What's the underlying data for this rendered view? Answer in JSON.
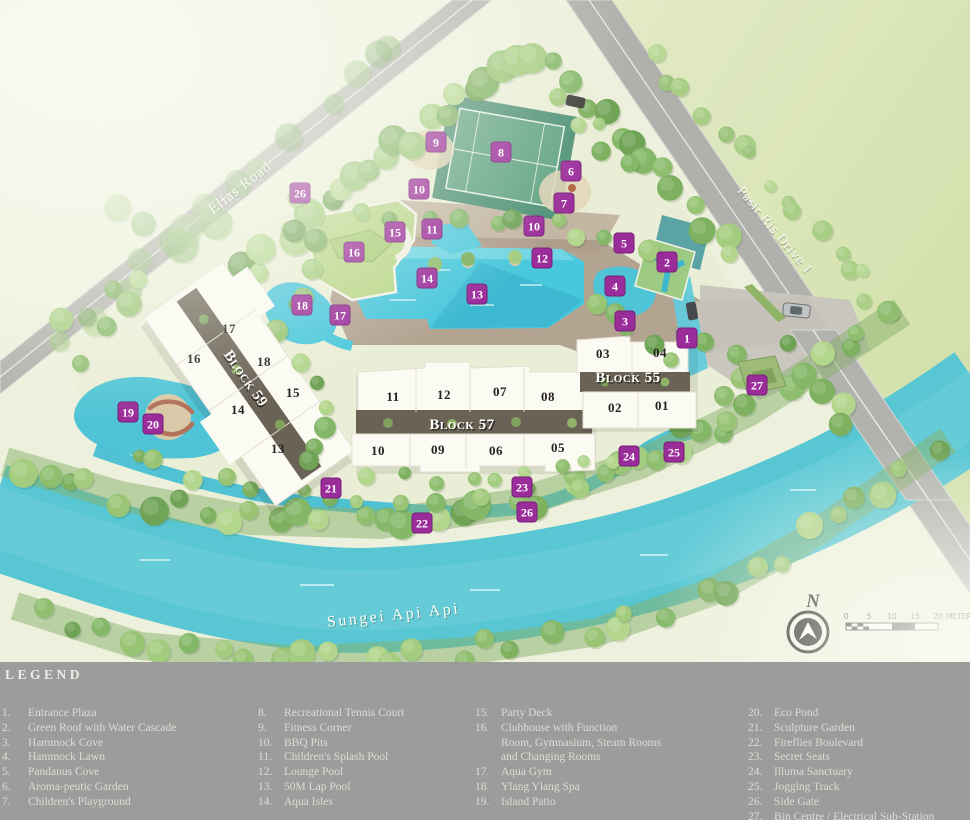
{
  "legend": {
    "title": "LEGEND",
    "columns": [
      {
        "x": 2,
        "items": [
          {
            "num": "1.",
            "label": "Entrance Plaza"
          },
          {
            "num": "2.",
            "label": "Green Roof with Water Cascade"
          },
          {
            "num": "3.",
            "label": "Hammock Cove"
          },
          {
            "num": "4.",
            "label": "Hammock Lawn"
          },
          {
            "num": "5.",
            "label": "Pandanus Cove"
          },
          {
            "num": "6.",
            "label": "Aroma-peutic Garden"
          },
          {
            "num": "7.",
            "label": "Children's Playground"
          }
        ]
      },
      {
        "x": 258,
        "items": [
          {
            "num": "8.",
            "label": "Recreational Tennis Court"
          },
          {
            "num": "9.",
            "label": "Fitness Corner"
          },
          {
            "num": "10.",
            "label": "BBQ Pits"
          },
          {
            "num": "11.",
            "label": "Children's Splash Pool"
          },
          {
            "num": "12.",
            "label": "Lounge Pool"
          },
          {
            "num": "13.",
            "label": "50M Lap Pool"
          },
          {
            "num": "14.",
            "label": "Aqua Isles"
          }
        ]
      },
      {
        "x": 475,
        "items": [
          {
            "num": "15.",
            "label": "Party Deck"
          },
          {
            "num": "16.",
            "label": "Clubhouse with Function\nRoom, Gymnasium, Steam Rooms\nand Changing Rooms"
          },
          {
            "num": "17.",
            "label": "Aqua Gym"
          },
          {
            "num": "18.",
            "label": "Ylang Ylang Spa"
          },
          {
            "num": "19.",
            "label": "Island Patio"
          }
        ]
      },
      {
        "x": 748,
        "items": [
          {
            "num": "20.",
            "label": "Eco Pond"
          },
          {
            "num": "21.",
            "label": "Sculpture Garden"
          },
          {
            "num": "22.",
            "label": "Fireflies Boulevard"
          },
          {
            "num": "23.",
            "label": "Secret Seats"
          },
          {
            "num": "24.",
            "label": "Illuma Sanctuary"
          },
          {
            "num": "25.",
            "label": "Jogging Track"
          },
          {
            "num": "26.",
            "label": "Side Gate"
          },
          {
            "num": "27.",
            "label": "Bin Centre / Electrical Sub-Station"
          }
        ]
      }
    ]
  },
  "map": {
    "place_labels": [
      {
        "text": "Elias Road",
        "x": 243,
        "y": 191,
        "rot": -38,
        "size": 15,
        "ls": 1
      },
      {
        "text": "Pasir Ris Drive 1",
        "x": 772,
        "y": 233,
        "rot": 50,
        "size": 13.5,
        "ls": 1
      },
      {
        "text": "Sungei Api Api",
        "x": 394,
        "y": 620,
        "rot": -6,
        "size": 16,
        "ls": 2.5
      }
    ],
    "block_labels": [
      {
        "text": "Block 59",
        "x": 242,
        "y": 381,
        "rot": 55
      },
      {
        "text": "Block 57",
        "x": 462,
        "y": 429,
        "rot": 0
      },
      {
        "text": "Block 55",
        "x": 628,
        "y": 382,
        "rot": 0
      }
    ],
    "unit_labels": [
      {
        "text": "17",
        "x": 229,
        "y": 333
      },
      {
        "text": "16",
        "x": 194,
        "y": 363
      },
      {
        "text": "18",
        "x": 264,
        "y": 366
      },
      {
        "text": "15",
        "x": 293,
        "y": 397
      },
      {
        "text": "14",
        "x": 238,
        "y": 414
      },
      {
        "text": "13",
        "x": 278,
        "y": 453
      },
      {
        "text": "11",
        "x": 393,
        "y": 401
      },
      {
        "text": "12",
        "x": 444,
        "y": 399
      },
      {
        "text": "07",
        "x": 500,
        "y": 396
      },
      {
        "text": "08",
        "x": 548,
        "y": 401
      },
      {
        "text": "10",
        "x": 378,
        "y": 455
      },
      {
        "text": "09",
        "x": 438,
        "y": 454
      },
      {
        "text": "06",
        "x": 496,
        "y": 455
      },
      {
        "text": "05",
        "x": 558,
        "y": 452
      },
      {
        "text": "03",
        "x": 603,
        "y": 358
      },
      {
        "text": "04",
        "x": 660,
        "y": 357
      },
      {
        "text": "02",
        "x": 615,
        "y": 412
      },
      {
        "text": "01",
        "x": 662,
        "y": 410
      }
    ],
    "markers": [
      {
        "n": "1",
        "x": 687,
        "y": 338
      },
      {
        "n": "2",
        "x": 667,
        "y": 262
      },
      {
        "n": "3",
        "x": 625,
        "y": 321
      },
      {
        "n": "4",
        "x": 615,
        "y": 286
      },
      {
        "n": "5",
        "x": 624,
        "y": 243
      },
      {
        "n": "6",
        "x": 571,
        "y": 171
      },
      {
        "n": "7",
        "x": 564,
        "y": 203
      },
      {
        "n": "8",
        "x": 501,
        "y": 152
      },
      {
        "n": "9",
        "x": 436,
        "y": 142
      },
      {
        "n": "10",
        "x": 419,
        "y": 189
      },
      {
        "n": "10",
        "x": 534,
        "y": 226
      },
      {
        "n": "11",
        "x": 432,
        "y": 229
      },
      {
        "n": "12",
        "x": 542,
        "y": 258
      },
      {
        "n": "13",
        "x": 477,
        "y": 294
      },
      {
        "n": "14",
        "x": 427,
        "y": 278
      },
      {
        "n": "15",
        "x": 395,
        "y": 232
      },
      {
        "n": "16",
        "x": 354,
        "y": 252
      },
      {
        "n": "17",
        "x": 340,
        "y": 315
      },
      {
        "n": "18",
        "x": 302,
        "y": 305
      },
      {
        "n": "19",
        "x": 128,
        "y": 412
      },
      {
        "n": "20",
        "x": 153,
        "y": 424
      },
      {
        "n": "21",
        "x": 331,
        "y": 488
      },
      {
        "n": "22",
        "x": 422,
        "y": 523
      },
      {
        "n": "23",
        "x": 522,
        "y": 487
      },
      {
        "n": "24",
        "x": 629,
        "y": 456
      },
      {
        "n": "25",
        "x": 674,
        "y": 452
      },
      {
        "n": "26",
        "x": 300,
        "y": 193
      },
      {
        "n": "26",
        "x": 527,
        "y": 512
      },
      {
        "n": "27",
        "x": 757,
        "y": 385
      }
    ],
    "compass": {
      "label": "N"
    },
    "scalebar": {
      "ticks": [
        "0",
        "5",
        "10",
        "15",
        "20"
      ],
      "unit": "METERS"
    }
  },
  "colors": {
    "marker": "#9B2D9B",
    "marker_edge": "#761F78",
    "marker_text": "#FFFFFF",
    "river": "#58C7D3",
    "pool": "#49C7DC",
    "road": "#AFAFAB",
    "court_outer": "#4F9177",
    "court_inner": "#61A383",
    "legend_bg": "#9C9C9A",
    "legend_text": "#DCDCD8",
    "building": "#FBFAF3",
    "roof_gap": "#6B6256"
  }
}
